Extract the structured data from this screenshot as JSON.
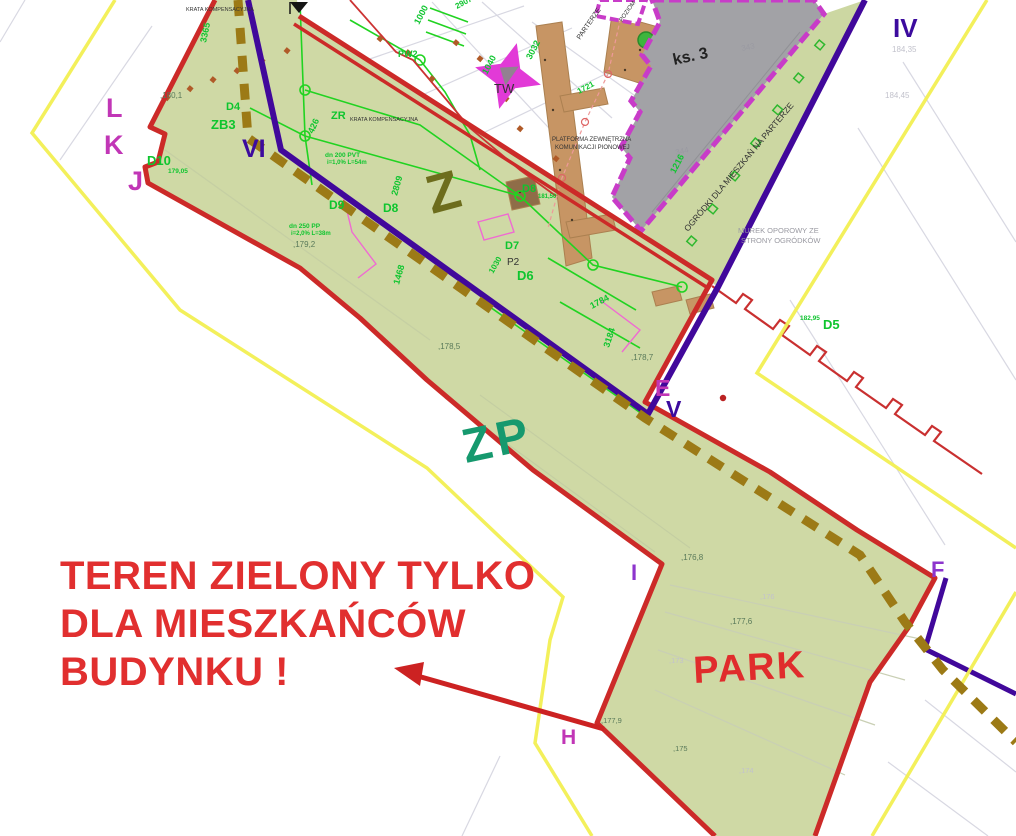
{
  "map": {
    "type": "site-development-plan",
    "zones": {
      "upper_zone_code": "Z",
      "green_zone_code": "ZP",
      "park_name": "PARK"
    },
    "annotation": [
      "TEREN ZIELONY TYLKO",
      "DLA MIESZKAŃCÓW",
      "BUDYNKU !"
    ],
    "survey_points": [
      "L",
      "K",
      "J",
      "VI",
      "IV",
      "E",
      "V",
      "I",
      "F",
      "H"
    ],
    "building_label": "ks. 3"
  },
  "colors": {
    "boundary_red": "#cc2a28",
    "annotation_red": "#e12f2f",
    "zone_green_fill": "#cfd9a5",
    "utility_green": "#21d321",
    "label_green": "#0ec52e",
    "survey_indigo": "#3c0b9e",
    "survey_magenta": "#c136b6",
    "survey_purple": "#8d35cd",
    "parcel_yellow": "#f2ef52",
    "path_brown_dash": "#9c7a16",
    "walkway_tan": "#c79564",
    "building_gray": "#a2a2a6",
    "building_border_magenta": "#c83cc8",
    "star_magenta": "#e23ad7",
    "zone_zp_text": "#16996e",
    "zone_z_text": "#6d6d1d"
  },
  "labels": [
    {
      "name": "zone-label-z",
      "text": "Z",
      "x": 432,
      "y": 214,
      "size": 54,
      "cls": "zone-z",
      "rot": -15
    },
    {
      "name": "zone-label-zp",
      "text": "ZP",
      "x": 466,
      "y": 463,
      "size": 48,
      "cls": "zone-zp",
      "rot": -12
    },
    {
      "name": "zone-label-park",
      "text": "PARK",
      "x": 694,
      "y": 683,
      "size": 38,
      "cls": "zone-park",
      "rot": -3
    },
    {
      "name": "annotation-line-1",
      "text": "TEREN ZIELONY TYLKO",
      "x": 60,
      "y": 589,
      "size": 40,
      "cls": "annotation"
    },
    {
      "name": "annotation-line-2",
      "text": "DLA MIESZKAŃCÓW",
      "x": 60,
      "y": 637,
      "size": 40,
      "cls": "annotation"
    },
    {
      "name": "annotation-line-3",
      "text": "BUDYNKU !",
      "x": 60,
      "y": 685,
      "size": 40,
      "cls": "annotation"
    },
    {
      "name": "survey-point-l",
      "text": "L",
      "x": 106,
      "y": 117,
      "size": 27,
      "cls": "pt-magenta"
    },
    {
      "name": "survey-point-k",
      "text": "K",
      "x": 104,
      "y": 154,
      "size": 27,
      "cls": "pt-magenta"
    },
    {
      "name": "survey-point-j",
      "text": "J",
      "x": 128,
      "y": 190,
      "size": 27,
      "cls": "pt-magenta"
    },
    {
      "name": "survey-point-vi",
      "text": "VI",
      "x": 242,
      "y": 157,
      "size": 25,
      "cls": "pt-indigo"
    },
    {
      "name": "survey-point-iv",
      "text": "IV",
      "x": 893,
      "y": 37,
      "size": 26,
      "cls": "pt-indigo"
    },
    {
      "name": "survey-point-e",
      "text": "E",
      "x": 655,
      "y": 396,
      "size": 23,
      "cls": "pt-magenta"
    },
    {
      "name": "survey-point-v",
      "text": "V",
      "x": 666,
      "y": 417,
      "size": 23,
      "cls": "pt-indigo"
    },
    {
      "name": "survey-point-i",
      "text": "I",
      "x": 631,
      "y": 580,
      "size": 22,
      "cls": "pt-purple"
    },
    {
      "name": "survey-point-f",
      "text": "F",
      "x": 931,
      "y": 577,
      "size": 22,
      "cls": "pt-purple"
    },
    {
      "name": "survey-point-h",
      "text": "H",
      "x": 561,
      "y": 744,
      "size": 21,
      "cls": "pt-magenta"
    },
    {
      "text": "D4",
      "x": 226,
      "y": 110,
      "size": 11,
      "cls": "lbl-green"
    },
    {
      "text": "ZB3",
      "x": 211,
      "y": 129,
      "size": 13,
      "cls": "lbl-green"
    },
    {
      "text": "D10",
      "x": 147,
      "y": 165,
      "size": 13,
      "cls": "lbl-green"
    },
    {
      "text": "179,05",
      "x": 168,
      "y": 173,
      "size": 6.5,
      "cls": "lbl-green"
    },
    {
      "text": "ZR",
      "x": 331,
      "y": 119,
      "size": 11,
      "cls": "lbl-green"
    },
    {
      "text": "426",
      "x": 313,
      "y": 134,
      "size": 9,
      "cls": "lbl-green",
      "rot": -65
    },
    {
      "text": "PW2",
      "x": 398,
      "y": 57,
      "size": 9,
      "cls": "lbl-green"
    },
    {
      "text": "D9",
      "x": 329,
      "y": 209,
      "size": 12,
      "cls": "lbl-green"
    },
    {
      "text": "D8",
      "x": 383,
      "y": 212,
      "size": 12,
      "cls": "lbl-green"
    },
    {
      "text": "2809",
      "x": 397,
      "y": 196,
      "size": 9,
      "cls": "lbl-green",
      "rot": -74
    },
    {
      "text": "D8",
      "x": 522,
      "y": 192,
      "size": 11,
      "cls": "lbl-green"
    },
    {
      "text": "181,50",
      "x": 538,
      "y": 198,
      "size": 6,
      "cls": "lbl-green"
    },
    {
      "text": "D7",
      "x": 505,
      "y": 249,
      "size": 11,
      "cls": "lbl-green"
    },
    {
      "text": "D6",
      "x": 517,
      "y": 280,
      "size": 13,
      "cls": "lbl-green"
    },
    {
      "text": "D5",
      "x": 823,
      "y": 329,
      "size": 13,
      "cls": "lbl-green"
    },
    {
      "text": "182,95",
      "x": 800,
      "y": 320,
      "size": 6.5,
      "cls": "lbl-green"
    },
    {
      "text": "1216",
      "x": 675,
      "y": 174,
      "size": 9,
      "cls": "lbl-green",
      "rot": -62
    },
    {
      "text": "1000",
      "x": 419,
      "y": 25,
      "size": 9,
      "cls": "lbl-green",
      "rot": -62
    },
    {
      "text": "1040",
      "x": 487,
      "y": 75,
      "size": 9,
      "cls": "lbl-green",
      "rot": -62
    },
    {
      "text": "3032",
      "x": 531,
      "y": 60,
      "size": 9,
      "cls": "lbl-green",
      "rot": -62
    },
    {
      "text": "2907",
      "x": 457,
      "y": 9,
      "size": 8,
      "cls": "lbl-green",
      "rot": -28
    },
    {
      "text": "1721",
      "x": 579,
      "y": 94,
      "size": 8,
      "cls": "lbl-green",
      "rot": -28
    },
    {
      "text": "3365",
      "x": 206,
      "y": 43,
      "size": 9,
      "cls": "lbl-green",
      "rot": -78
    },
    {
      "text": "1468",
      "x": 399,
      "y": 285,
      "size": 9,
      "cls": "lbl-green",
      "rot": -74
    },
    {
      "text": "1784",
      "x": 592,
      "y": 309,
      "size": 9,
      "cls": "lbl-green",
      "rot": -28
    },
    {
      "text": "3184",
      "x": 609,
      "y": 348,
      "size": 9,
      "cls": "lbl-green",
      "rot": -72
    },
    {
      "text": "1030",
      "x": 493,
      "y": 274,
      "size": 8,
      "cls": "lbl-green",
      "rot": -60
    },
    {
      "text": "dn 200 PVT",
      "x": 325,
      "y": 157,
      "size": 6.5,
      "cls": "lbl-green"
    },
    {
      "text": "i=1,0% L=54m",
      "x": 327,
      "y": 164,
      "size": 6,
      "cls": "lbl-green"
    },
    {
      "text": "dn 250 PP",
      "x": 289,
      "y": 228,
      "size": 6.5,
      "cls": "lbl-green"
    },
    {
      "text": "i=2,0% L=38m",
      "x": 291,
      "y": 235,
      "size": 6,
      "cls": "lbl-green"
    },
    {
      "text": "TW",
      "x": 494,
      "y": 93,
      "size": 13,
      "cls": "lbl-dark"
    },
    {
      "name": "building-label",
      "text": "ks. 3",
      "x": 674,
      "y": 65,
      "size": 16,
      "cls": "lbl-dark-bold",
      "rot": -12
    },
    {
      "text": "P2",
      "x": 507,
      "y": 265,
      "size": 10,
      "cls": "lbl-dark"
    },
    {
      "text": "KRATA KOMPENSACYJNA",
      "x": 350,
      "y": 121,
      "size": 5.5,
      "cls": "lbl-dark"
    },
    {
      "text": "KRATA KOMPENSACYJNA",
      "x": 186,
      "y": 11,
      "size": 5.5,
      "cls": "lbl-dark"
    },
    {
      "text": "PLATFORMA ZEWNĘTRZNA",
      "x": 552,
      "y": 141,
      "size": 6,
      "cls": "lbl-dark"
    },
    {
      "text": "KOMUNIKACJI PIONOWEJ",
      "x": 555,
      "y": 149,
      "size": 6,
      "cls": "lbl-dark"
    },
    {
      "name": "garden-strip-label",
      "text": "OGRÓDKI DLA MIESZKAŃ NA PARTERZE",
      "x": 688,
      "y": 232,
      "size": 8.5,
      "cls": "lbl-dark",
      "rot": -50
    },
    {
      "text": "PARTERZE",
      "x": 580,
      "y": 40,
      "size": 7,
      "cls": "lbl-dark",
      "rot": -55
    },
    {
      "text": "POZIOM",
      "x": 622,
      "y": 22,
      "size": 6,
      "cls": "lbl-dark",
      "rot": -55
    },
    {
      "text": "MUREK OPOROWY ZE",
      "x": 738,
      "y": 233,
      "size": 7.5,
      "cls": "lbl-gray"
    },
    {
      "text": "STRONY OGRÓDKÓW",
      "x": 741,
      "y": 243,
      "size": 7.5,
      "cls": "lbl-gray"
    },
    {
      "text": "343",
      "x": 742,
      "y": 51,
      "size": 8,
      "cls": "lbl-gray",
      "rot": -12
    },
    {
      "text": "344",
      "x": 676,
      "y": 155,
      "size": 8,
      "cls": "lbl-gray",
      "rot": -12
    },
    {
      "text": ",180,1",
      "x": 160,
      "y": 98,
      "size": 8,
      "cls": "lbl-elev"
    },
    {
      "text": ",179,2",
      "x": 293,
      "y": 247,
      "size": 8,
      "cls": "lbl-elev"
    },
    {
      "text": ",178,5",
      "x": 438,
      "y": 349,
      "size": 8,
      "cls": "lbl-elev"
    },
    {
      "text": ",178,7",
      "x": 631,
      "y": 360,
      "size": 8,
      "cls": "lbl-elev"
    },
    {
      "text": ",176,8",
      "x": 681,
      "y": 560,
      "size": 8,
      "cls": "lbl-elev"
    },
    {
      "text": ",177,6",
      "x": 730,
      "y": 624,
      "size": 8,
      "cls": "lbl-elev"
    },
    {
      "text": ",177,9",
      "x": 601,
      "y": 723,
      "size": 7.5,
      "cls": "lbl-elev"
    },
    {
      "text": ",175",
      "x": 673,
      "y": 751,
      "size": 7.5,
      "cls": "lbl-elev"
    },
    {
      "text": "184,35",
      "x": 892,
      "y": 52,
      "size": 8,
      "cls": "lbl-faint"
    },
    {
      "text": "184,45",
      "x": 885,
      "y": 98,
      "size": 8,
      "cls": "lbl-faint"
    },
    {
      "text": ",176",
      "x": 760,
      "y": 599,
      "size": 7.5,
      "cls": "lbl-faint"
    },
    {
      "text": ",174",
      "x": 739,
      "y": 773,
      "size": 7.5,
      "cls": "lbl-faint"
    },
    {
      "text": ",173",
      "x": 669,
      "y": 663,
      "size": 7.5,
      "cls": "lbl-faint"
    }
  ]
}
